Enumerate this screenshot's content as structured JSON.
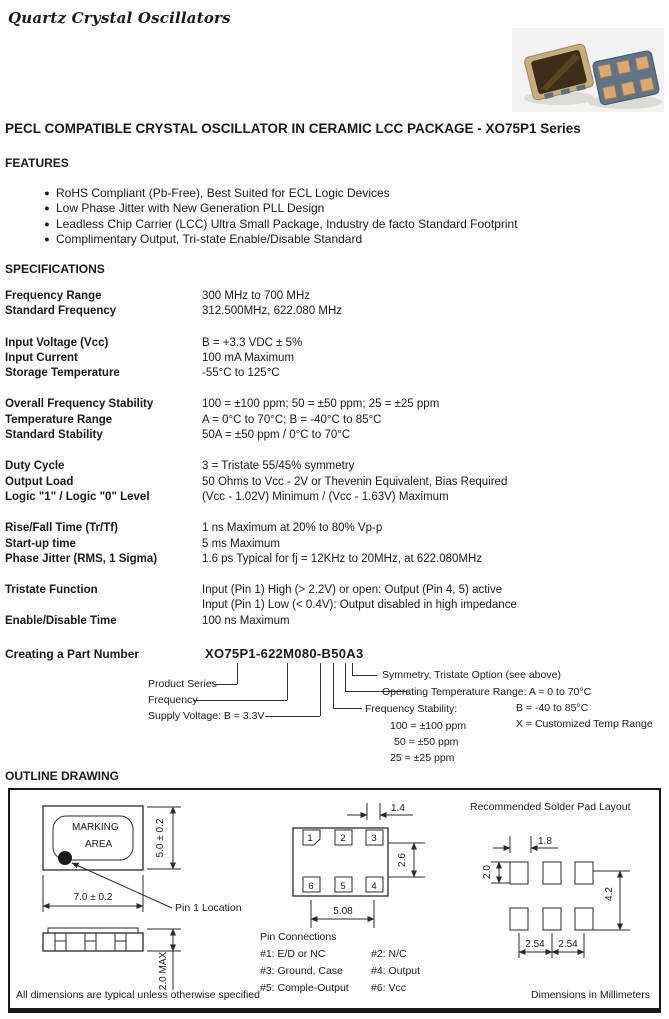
{
  "page": {
    "brand_title": "Quartz Crystal Oscillators",
    "main_heading": "PECL COMPATIBLE CRYSTAL OSCILLATOR IN CERAMIC LCC PACKAGE - XO75P1 Series"
  },
  "colors": {
    "text": "#1a1a1a",
    "line": "#2a2a2a",
    "chip_ceramic": "#c7ae7e",
    "chip_lid": "#3c2d16",
    "chip_body_blue": "#5f7486",
    "chip_pad": "#d9a873",
    "photo_bg": "#f3f3f1"
  },
  "features": {
    "heading": "FEATURES",
    "items": [
      "RoHS Compliant (Pb-Free), Best Suited for ECL Logic Devices",
      "Low Phase Jitter with New Generation PLL Design",
      "Leadless Chip Carrier (LCC) Ultra Small Package, Industry de facto Standard Footprint",
      "Complimentary Output, Tri-state Enable/Disable Standard"
    ]
  },
  "specifications": {
    "heading": "SPECIFICATIONS",
    "rows": [
      {
        "label": "Frequency Range",
        "value": "300 MHz to 700 MHz"
      },
      {
        "label": "Standard Frequency",
        "value": "312.500MHz, 622.080 MHz"
      },
      {
        "label": "Input Voltage (Vcc)",
        "value": "B = +3.3 VDC ± 5%"
      },
      {
        "label": "Input Current",
        "value": "100 mA Maximum"
      },
      {
        "label": "Storage Temperature",
        "value": "-55°C to 125°C"
      },
      {
        "label": "Overall Frequency Stability",
        "value": "100 = ±100 ppm;  50 = ±50 ppm;  25 = ±25 ppm"
      },
      {
        "label": "Temperature Range",
        "value": "A = 0°C to 70°C;  B = -40°C to 85°C"
      },
      {
        "label": "Standard Stability",
        "value": "50A = ±50 ppm / 0°C to 70°C"
      },
      {
        "label": "Duty Cycle",
        "value": "3 = Tristate 55/45% symmetry"
      },
      {
        "label": "Output Load",
        "value": "50 Ohms to Vcc - 2V or Thevenin Equivalent, Bias Required"
      },
      {
        "label": "Logic \"1\" / Logic \"0\" Level",
        "value": "(Vcc - 1.02V) Minimum / (Vcc - 1.63V) Maximum"
      },
      {
        "label": "Rise/Fall Time (Tr/Tf)",
        "value": "1 ns Maximum at 20% to 80% Vp-p"
      },
      {
        "label": "Start-up time",
        "value": "5 ms Maximum"
      },
      {
        "label": "Phase Jitter (RMS, 1 Sigma)",
        "value": "1.6 ps Typical for fj = 12KHz to 20MHz, at 622.080MHz"
      },
      {
        "label": "Tristate Function",
        "value": "Input (Pin 1) High (> 2.2V) or open: Output (Pin 4, 5) active"
      },
      {
        "label": "",
        "value": "Input (Pin 1) Low (< 0.4V): Output disabled in high impedance"
      },
      {
        "label": "Enable/Disable Time",
        "value": "100 ns Maximum"
      }
    ]
  },
  "part_number": {
    "heading": "Creating a Part Number",
    "number": "XO75P1-622M080-B50A3",
    "labels": {
      "product_series": "Product Series",
      "frequency": "Frequency",
      "supply_voltage": "Supply Voltage: B = 3.3V",
      "symmetry": "Symmetry, Tristate Option (see above)",
      "op_temp": "Operating Temperature Range: A = 0 to 70°C",
      "op_temp_b": "B = -40 to 85°C",
      "op_temp_x": "X = Customized Temp Range",
      "freq_stability": "Frequency Stability:",
      "fs_100": "100 = ±100 ppm",
      "fs_50": "50 = ±50 ppm",
      "fs_25": "25 = ±25 ppm"
    }
  },
  "outline": {
    "heading": "OUTLINE DRAWING",
    "marking_line1": "MARKING",
    "marking_line2": "AREA",
    "dim_width": "7.0 ± 0.2",
    "dim_height": "5.0 ± 0.2",
    "dim_thickness": "2.0 MAX",
    "pin1_location": "Pin 1 Location",
    "pad_numbers": [
      "1",
      "2",
      "3",
      "6",
      "5",
      "4"
    ],
    "dim_pad_width": "1.4",
    "dim_row_gap": "2.6",
    "dim_pad_span": "5.08",
    "solder_pad_title": "Recommended Solder Pad Layout",
    "dim_sp_width": "1.8",
    "dim_sp_height": "2.0",
    "dim_sp_vspan": "4.2",
    "dim_sp_pitch1": "2.54",
    "dim_sp_pitch2": "2.54",
    "pin_connections_title": "Pin Connections",
    "pin_connections": [
      "#1: E/D or NC",
      "#2: N/C",
      "#3: Ground, Case",
      "#4: Output",
      "#5: Comple-Output",
      "#6: Vcc"
    ],
    "footnote_left": "All dimensions are typical unless otherwise specified",
    "footnote_right": "Dimensions in Millimeters"
  }
}
